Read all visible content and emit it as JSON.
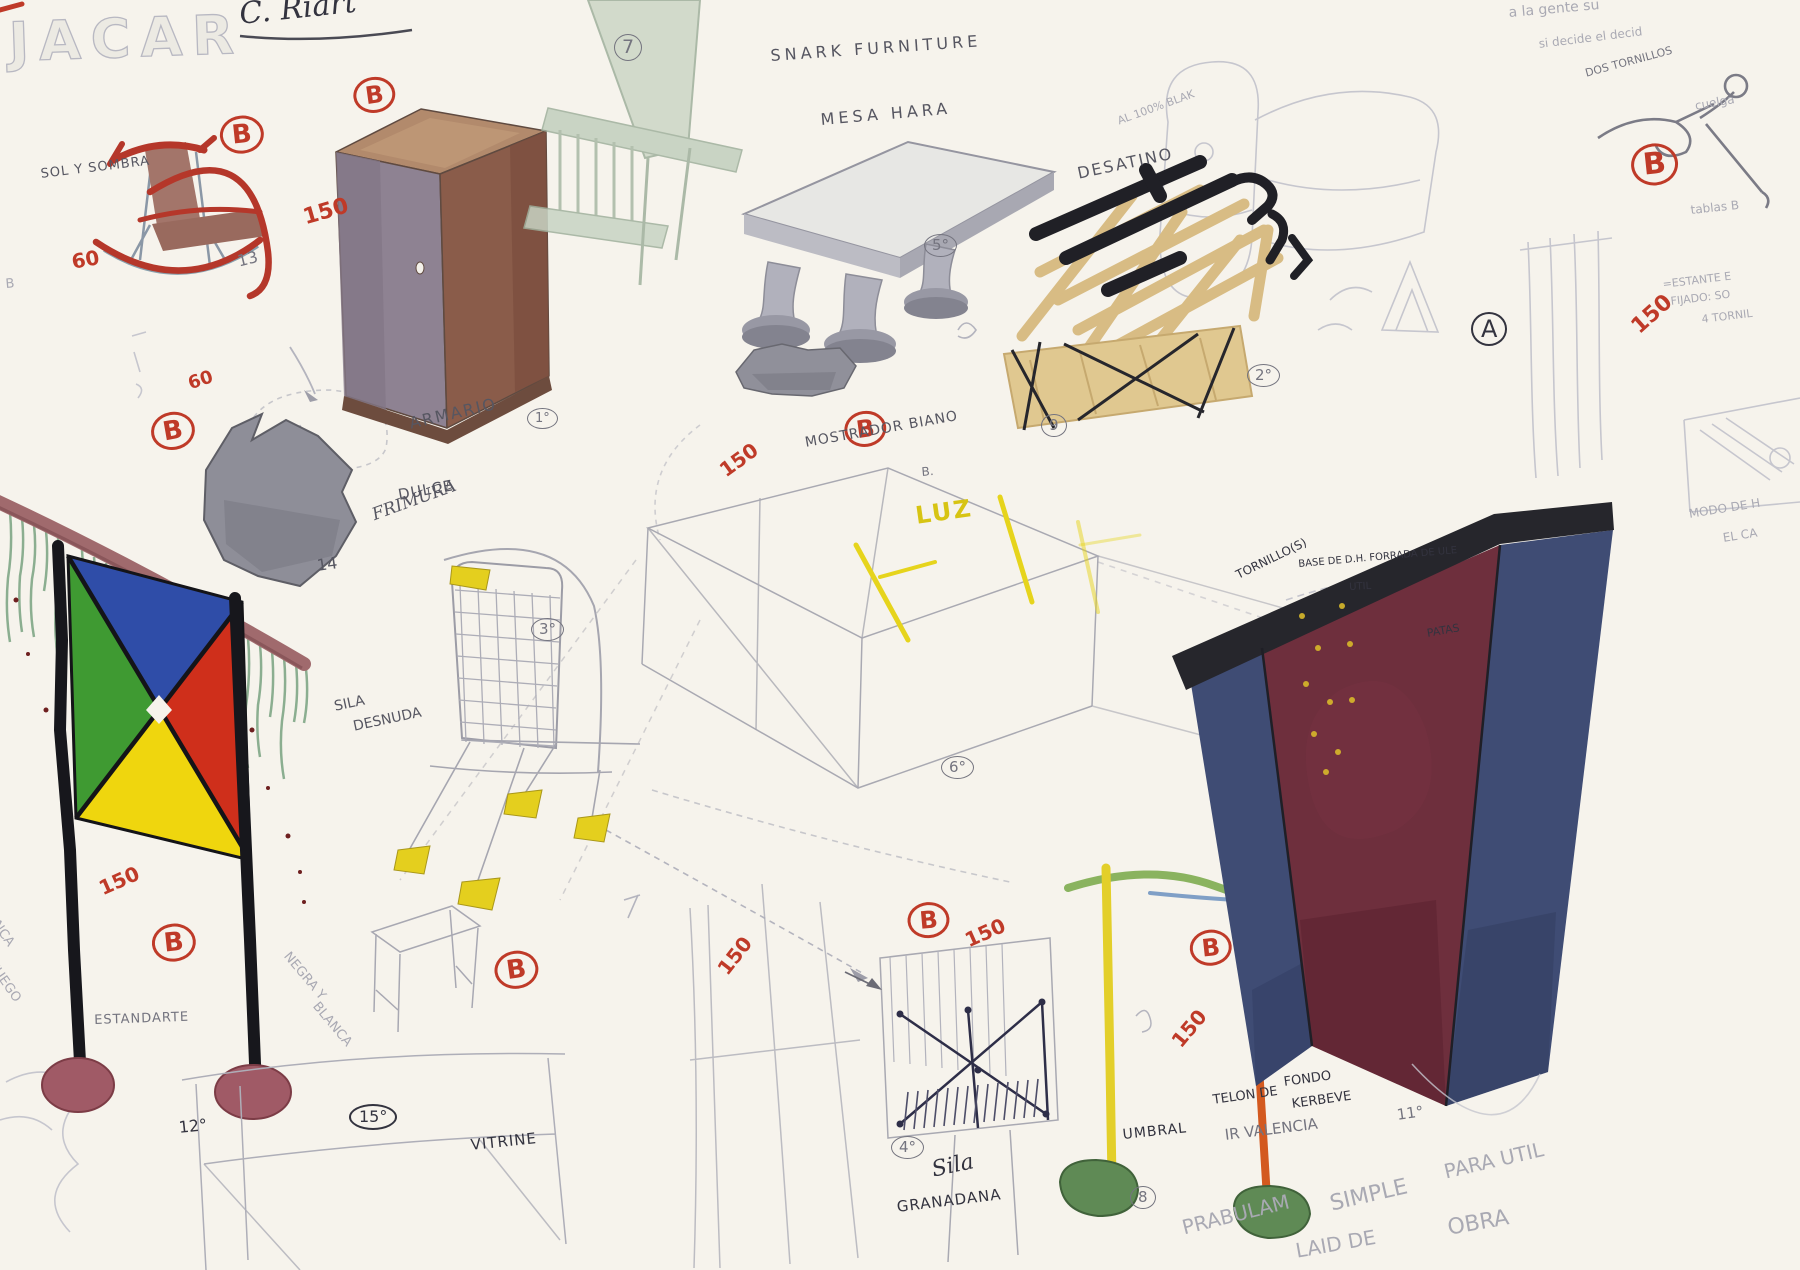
{
  "page": {
    "watermark": "JACAR",
    "signature": "C. Riart",
    "description": "Hand-drawn furniture design sketchbook page, pencil and watercolor"
  },
  "palette": {
    "paper": "#f6f3ec",
    "red": "#bf3a28",
    "pencil": "#74747f",
    "pencil_faint": "#a9a9b3",
    "dark": "#565661",
    "ink": "#33333f",
    "yellow": "#d7c413",
    "banner_blue": "#2f4da8",
    "banner_green": "#3f9a32",
    "banner_red": "#cf2f1b",
    "banner_yellow": "#efd60e",
    "curtain_maroon": "#6e2f3d",
    "curtain_navy": "#3f4c74",
    "frame_tan": "#d8bc84",
    "hardware_black": "#1f1f26",
    "chair_sage": "#c8d4c4",
    "cabinet_brown": "#8a5c4a",
    "cabinet_gray": "#8e8292",
    "cabinet_top": "#b28a6c",
    "chair_leather_brown": "#a3756a",
    "base_maroon": "#a05a66",
    "pole_yellow": "#e3cf2a",
    "pole_orange": "#d3591f",
    "foot_green": "#5f8a55",
    "rock_gray": "#8e8e98",
    "table_gray": "#b1b1bc"
  },
  "furniture_sketches": [
    "rocking chair — SOL Y SOMBRA",
    "cabinet — ARMARIO",
    "high-back chair — SNARK FURNITURE",
    "table — MESA HARA",
    "folding lounger — DESATINO",
    "rock study",
    "banner — ESTANDARTE",
    "counter — MOSTRADOR BIANO with LUZ",
    "chair — SILA DESNUDA",
    "display case — VITRINE",
    "chair — SILA GRANADANA",
    "doorway — UMBRAL",
    "backdrop curtain — TELON DE FONDO"
  ],
  "annotations": [
    {
      "name": "watermark",
      "text": "JACAR",
      "x": 8,
      "y": 16,
      "size": 54,
      "rot": -2,
      "color": "pencil_faint",
      "outline": true,
      "ls": 10
    },
    {
      "name": "artist-signature",
      "text": "C. Riart",
      "x": 238,
      "y": 0,
      "size": 30,
      "rot": -6,
      "color": "ink",
      "serif": true
    },
    {
      "name": "mark-7-circled",
      "text": "7",
      "x": 614,
      "y": 34,
      "size": 19,
      "rot": 0,
      "color": "pencil",
      "circled": "pencil"
    },
    {
      "name": "label-snark-furniture",
      "text": "SNARK FURNITURE",
      "x": 770,
      "y": 48,
      "size": 16,
      "rot": -4,
      "color": "dark",
      "ls": 4
    },
    {
      "name": "label-mesa-hara",
      "text": "MESA HARA",
      "x": 820,
      "y": 112,
      "size": 16,
      "rot": -5,
      "color": "dark",
      "ls": 4
    },
    {
      "name": "mark-b-rocking-chair",
      "text": "B",
      "x": 218,
      "y": 118,
      "size": 26,
      "rot": -6,
      "color": "red",
      "circled": "red",
      "bold": true
    },
    {
      "name": "label-sol-y-sombra",
      "text": "SOL Y SOMBRA",
      "x": 40,
      "y": 168,
      "size": 13,
      "rot": -7,
      "color": "dark",
      "ls": 1
    },
    {
      "name": "dim-60-rocking-chair",
      "text": "60",
      "x": 70,
      "y": 252,
      "size": 20,
      "rot": -10,
      "color": "red",
      "bold": true
    },
    {
      "name": "dim-13",
      "text": "13",
      "x": 236,
      "y": 254,
      "size": 16,
      "rot": -14,
      "color": "pencil"
    },
    {
      "name": "mark-b-small",
      "text": "B",
      "x": 5,
      "y": 278,
      "size": 13,
      "rot": -5,
      "color": "pencil_faint"
    },
    {
      "name": "mark-b-cabinet",
      "text": "B",
      "x": 351,
      "y": 80,
      "size": 24,
      "rot": -8,
      "color": "red",
      "circled": "red",
      "bold": true
    },
    {
      "name": "dim-150-cabinet",
      "text": "150",
      "x": 301,
      "y": 208,
      "size": 22,
      "rot": -16,
      "color": "red",
      "bold": true
    },
    {
      "name": "label-armario",
      "text": "ARMARIO",
      "x": 408,
      "y": 416,
      "size": 16,
      "rot": -13,
      "color": "dark",
      "ls": 2
    },
    {
      "name": "mark-1-circled",
      "text": "1°",
      "x": 527,
      "y": 408,
      "size": 13,
      "rot": 0,
      "color": "pencil",
      "circled": "pencil"
    },
    {
      "name": "label-desatino",
      "text": "DESATINO",
      "x": 1076,
      "y": 166,
      "size": 16,
      "rot": -12,
      "color": "dark",
      "ls": 2
    },
    {
      "name": "note-al-100-blak",
      "text": "AL 100% BLAK",
      "x": 1116,
      "y": 116,
      "size": 11,
      "rot": -20,
      "color": "pencil_faint"
    },
    {
      "name": "mark-5-circled",
      "text": "5°",
      "x": 924,
      "y": 234,
      "size": 15,
      "rot": 0,
      "color": "pencil",
      "circled": "pencil"
    },
    {
      "name": "mark-2-circled",
      "text": "2°",
      "x": 1247,
      "y": 364,
      "size": 15,
      "rot": 0,
      "color": "pencil",
      "circled": "pencil"
    },
    {
      "name": "mark-9-circled",
      "text": "9",
      "x": 1041,
      "y": 414,
      "size": 15,
      "rot": 0,
      "color": "pencil",
      "circled": "pencil"
    },
    {
      "name": "mark-b-top-right",
      "text": "B",
      "x": 1629,
      "y": 146,
      "size": 30,
      "rot": -6,
      "color": "red",
      "circled": "red",
      "bold": true
    },
    {
      "name": "note-gente",
      "text": "a la gente su",
      "x": 1508,
      "y": 6,
      "size": 14,
      "rot": -5,
      "color": "pencil_faint"
    },
    {
      "name": "note-decide",
      "text": "si decide el decid",
      "x": 1538,
      "y": 38,
      "size": 12,
      "rot": -7,
      "color": "pencil_faint"
    },
    {
      "name": "note-dos-tornillos",
      "text": "DOS TORNILLOS",
      "x": 1584,
      "y": 68,
      "size": 11,
      "rot": -15,
      "color": "pencil"
    },
    {
      "name": "note-cuelga",
      "text": "cuelga",
      "x": 1694,
      "y": 100,
      "size": 12,
      "rot": -10,
      "color": "pencil_faint"
    },
    {
      "name": "note-tablas",
      "text": "tablas B",
      "x": 1690,
      "y": 204,
      "size": 12,
      "rot": -6,
      "color": "pencil_faint"
    },
    {
      "name": "note-estante",
      "text": "=ESTANTE E",
      "x": 1662,
      "y": 279,
      "size": 11,
      "rot": -7,
      "color": "pencil_faint"
    },
    {
      "name": "note-fijado",
      "text": "FIJADO: SO",
      "x": 1670,
      "y": 296,
      "size": 11,
      "rot": -7,
      "color": "pencil_faint"
    },
    {
      "name": "note-4-tornillos",
      "text": "4 TORNIL",
      "x": 1701,
      "y": 314,
      "size": 11,
      "rot": -7,
      "color": "pencil_faint"
    },
    {
      "name": "dim-150-top-right",
      "text": "150",
      "x": 1628,
      "y": 322,
      "size": 22,
      "rot": -42,
      "color": "red",
      "bold": true
    },
    {
      "name": "mark-a-circled",
      "text": "A",
      "x": 1471,
      "y": 312,
      "size": 24,
      "rot": 0,
      "color": "ink",
      "circled": "dark"
    },
    {
      "name": "mark-b-rock",
      "text": "B",
      "x": 148,
      "y": 416,
      "size": 26,
      "rot": -10,
      "color": "red",
      "circled": "red",
      "bold": true
    },
    {
      "name": "dim-60-rock",
      "text": "60",
      "x": 186,
      "y": 376,
      "size": 18,
      "rot": -18,
      "color": "red",
      "bold": true
    },
    {
      "name": "label-dulce",
      "text": "DULCE",
      "x": 397,
      "y": 488,
      "size": 15,
      "rot": -10,
      "color": "dark",
      "ls": 1
    },
    {
      "name": "label-frimura",
      "text": "FRIMURA",
      "x": 370,
      "y": 508,
      "size": 17,
      "rot": -20,
      "color": "dark",
      "serif": true
    },
    {
      "name": "dim-14",
      "text": "14",
      "x": 316,
      "y": 558,
      "size": 16,
      "rot": -8,
      "color": "dark"
    },
    {
      "name": "mark-b-counter",
      "text": "B",
      "x": 842,
      "y": 414,
      "size": 24,
      "rot": -8,
      "color": "red",
      "circled": "red",
      "bold": true
    },
    {
      "name": "label-mostrador",
      "text": "MOSTRADOR BIANO",
      "x": 804,
      "y": 436,
      "size": 14,
      "rot": -10,
      "color": "dark",
      "ls": 1
    },
    {
      "name": "label-mostrador-b",
      "text": "B.",
      "x": 921,
      "y": 466,
      "size": 12,
      "rot": -5,
      "color": "pencil"
    },
    {
      "name": "dim-150-counter",
      "text": "150",
      "x": 716,
      "y": 464,
      "size": 20,
      "rot": -36,
      "color": "red",
      "bold": true
    },
    {
      "name": "label-luz",
      "text": "LUZ",
      "x": 914,
      "y": 504,
      "size": 24,
      "rot": -8,
      "color": "yellow",
      "bold": true,
      "ls": 2
    },
    {
      "name": "mark-6-circled",
      "text": "6°",
      "x": 941,
      "y": 756,
      "size": 15,
      "rot": 0,
      "color": "pencil",
      "circled": "pencil"
    },
    {
      "name": "note-tornillos",
      "text": "TORNILLO(S)",
      "x": 1234,
      "y": 570,
      "size": 12,
      "rot": -26,
      "color": "ink"
    },
    {
      "name": "note-base",
      "text": "BASE DE D.H. FORRADA DE ULE",
      "x": 1298,
      "y": 560,
      "size": 10,
      "rot": -5,
      "color": "ink"
    },
    {
      "name": "note-util",
      "text": "UTIL",
      "x": 1349,
      "y": 583,
      "size": 10,
      "rot": -3,
      "color": "ink"
    },
    {
      "name": "note-patas",
      "text": "PATAS",
      "x": 1426,
      "y": 628,
      "size": 11,
      "rot": -10,
      "color": "ink"
    },
    {
      "name": "note-modo-de",
      "text": "MODO DE H",
      "x": 1688,
      "y": 508,
      "size": 12,
      "rot": -9,
      "color": "pencil_faint"
    },
    {
      "name": "note-el-ca",
      "text": "EL CA",
      "x": 1722,
      "y": 532,
      "size": 12,
      "rot": -9,
      "color": "pencil_faint"
    },
    {
      "name": "mark-b-banner",
      "text": "B",
      "x": 150,
      "y": 926,
      "size": 26,
      "rot": -6,
      "color": "red",
      "circled": "red",
      "bold": true
    },
    {
      "name": "dim-150-banner",
      "text": "150",
      "x": 96,
      "y": 880,
      "size": 20,
      "rot": -24,
      "color": "red",
      "bold": true
    },
    {
      "name": "label-estandarte",
      "text": "ESTANDARTE",
      "x": 94,
      "y": 1014,
      "size": 13,
      "rot": -2,
      "color": "pencil",
      "ls": 1
    },
    {
      "name": "dim-12",
      "text": "12°",
      "x": 178,
      "y": 1120,
      "size": 16,
      "rot": -6,
      "color": "ink"
    },
    {
      "name": "mark-15-circled",
      "text": "15°",
      "x": 349,
      "y": 1104,
      "size": 16,
      "rot": 0,
      "color": "ink",
      "circled": "dark"
    },
    {
      "name": "note-negra-y",
      "text": "NEGRA Y",
      "x": 291,
      "y": 950,
      "size": 13,
      "rot": 50,
      "color": "pencil_faint"
    },
    {
      "name": "note-blanca",
      "text": "BLANCA",
      "x": 320,
      "y": 1000,
      "size": 13,
      "rot": 50,
      "color": "pencil_faint"
    },
    {
      "name": "note-blanca-2",
      "text": "BLANCA",
      "x": -14,
      "y": 898,
      "size": 13,
      "rot": 55,
      "color": "pencil_faint"
    },
    {
      "name": "note-y-fuego",
      "text": "Y FUEGO",
      "x": -10,
      "y": 950,
      "size": 13,
      "rot": 55,
      "color": "pencil_faint"
    },
    {
      "name": "label-sila",
      "text": "SILA",
      "x": 333,
      "y": 700,
      "size": 14,
      "rot": -12,
      "color": "dark"
    },
    {
      "name": "label-desnuda",
      "text": "DESNUDA",
      "x": 352,
      "y": 720,
      "size": 14,
      "rot": -12,
      "color": "dark"
    },
    {
      "name": "mark-3-circled",
      "text": "3°",
      "x": 531,
      "y": 618,
      "size": 15,
      "rot": 0,
      "color": "pencil",
      "circled": "pencil"
    },
    {
      "name": "mark-b-vitrine",
      "text": "B",
      "x": 492,
      "y": 954,
      "size": 26,
      "rot": -8,
      "color": "red",
      "circled": "red",
      "bold": true
    },
    {
      "name": "dim-150-vitrine",
      "text": "150",
      "x": 714,
      "y": 966,
      "size": 20,
      "rot": -52,
      "color": "red",
      "bold": true
    },
    {
      "name": "label-vitrine",
      "text": "VITRINE",
      "x": 470,
      "y": 1138,
      "size": 15,
      "rot": -6,
      "color": "ink",
      "ls": 1
    },
    {
      "name": "mark-b-gate",
      "text": "B",
      "x": 906,
      "y": 904,
      "size": 24,
      "rot": -5,
      "color": "red",
      "circled": "red",
      "bold": true
    },
    {
      "name": "dim-150-gate",
      "text": "150",
      "x": 962,
      "y": 932,
      "size": 20,
      "rot": -24,
      "color": "red",
      "bold": true
    },
    {
      "name": "mark-4-circled",
      "text": "4°",
      "x": 891,
      "y": 1136,
      "size": 15,
      "rot": 0,
      "color": "pencil",
      "circled": "pencil"
    },
    {
      "name": "label-sila-granadana-1",
      "text": "Sila",
      "x": 930,
      "y": 1160,
      "size": 22,
      "rot": -12,
      "color": "ink",
      "serif": true
    },
    {
      "name": "label-sila-granadana-2",
      "text": "GRANADANA",
      "x": 896,
      "y": 1200,
      "size": 15,
      "rot": -7,
      "color": "ink",
      "ls": 1
    },
    {
      "name": "label-umbral",
      "text": "UMBRAL",
      "x": 1122,
      "y": 1128,
      "size": 14,
      "rot": -6,
      "color": "ink",
      "ls": 1
    },
    {
      "name": "mark-8-circled",
      "text": "8",
      "x": 1130,
      "y": 1186,
      "size": 15,
      "rot": 0,
      "color": "pencil",
      "circled": "pencil"
    },
    {
      "name": "mark-b-umbral",
      "text": "B",
      "x": 1188,
      "y": 932,
      "size": 24,
      "rot": -6,
      "color": "red",
      "circled": "red",
      "bold": true
    },
    {
      "name": "dim-150-umbral",
      "text": "150",
      "x": 1168,
      "y": 1038,
      "size": 20,
      "rot": -50,
      "color": "red",
      "bold": true
    },
    {
      "name": "label-telon-1",
      "text": "TELON DE",
      "x": 1212,
      "y": 1094,
      "size": 13,
      "rot": -8,
      "color": "ink"
    },
    {
      "name": "label-telon-2",
      "text": "FONDO",
      "x": 1283,
      "y": 1076,
      "size": 13,
      "rot": -8,
      "color": "ink"
    },
    {
      "name": "label-telon-3",
      "text": "KERBEVE",
      "x": 1291,
      "y": 1098,
      "size": 13,
      "rot": -8,
      "color": "ink"
    },
    {
      "name": "label-ir-valencia",
      "text": "IR VALENCIA",
      "x": 1224,
      "y": 1128,
      "size": 15,
      "rot": -7,
      "color": "pencil"
    },
    {
      "name": "dim-11",
      "text": "11°",
      "x": 1396,
      "y": 1108,
      "size": 15,
      "rot": -8,
      "color": "pencil"
    },
    {
      "name": "scrawl-prabulam",
      "text": "PRABULAM",
      "x": 1180,
      "y": 1218,
      "size": 20,
      "rot": -14,
      "color": "pencil_faint"
    },
    {
      "name": "scrawl-simple",
      "text": "SIMPLE",
      "x": 1328,
      "y": 1194,
      "size": 22,
      "rot": -13,
      "color": "pencil_faint"
    },
    {
      "name": "scrawl-para-util",
      "text": "PARA UTIL",
      "x": 1442,
      "y": 1162,
      "size": 20,
      "rot": -13,
      "color": "pencil_faint"
    },
    {
      "name": "scrawl-laid-de",
      "text": "LAID DE",
      "x": 1294,
      "y": 1241,
      "size": 20,
      "rot": -10,
      "color": "pencil_faint"
    },
    {
      "name": "scrawl-obra",
      "text": "OBRA",
      "x": 1446,
      "y": 1218,
      "size": 22,
      "rot": -10,
      "color": "pencil_faint"
    }
  ]
}
